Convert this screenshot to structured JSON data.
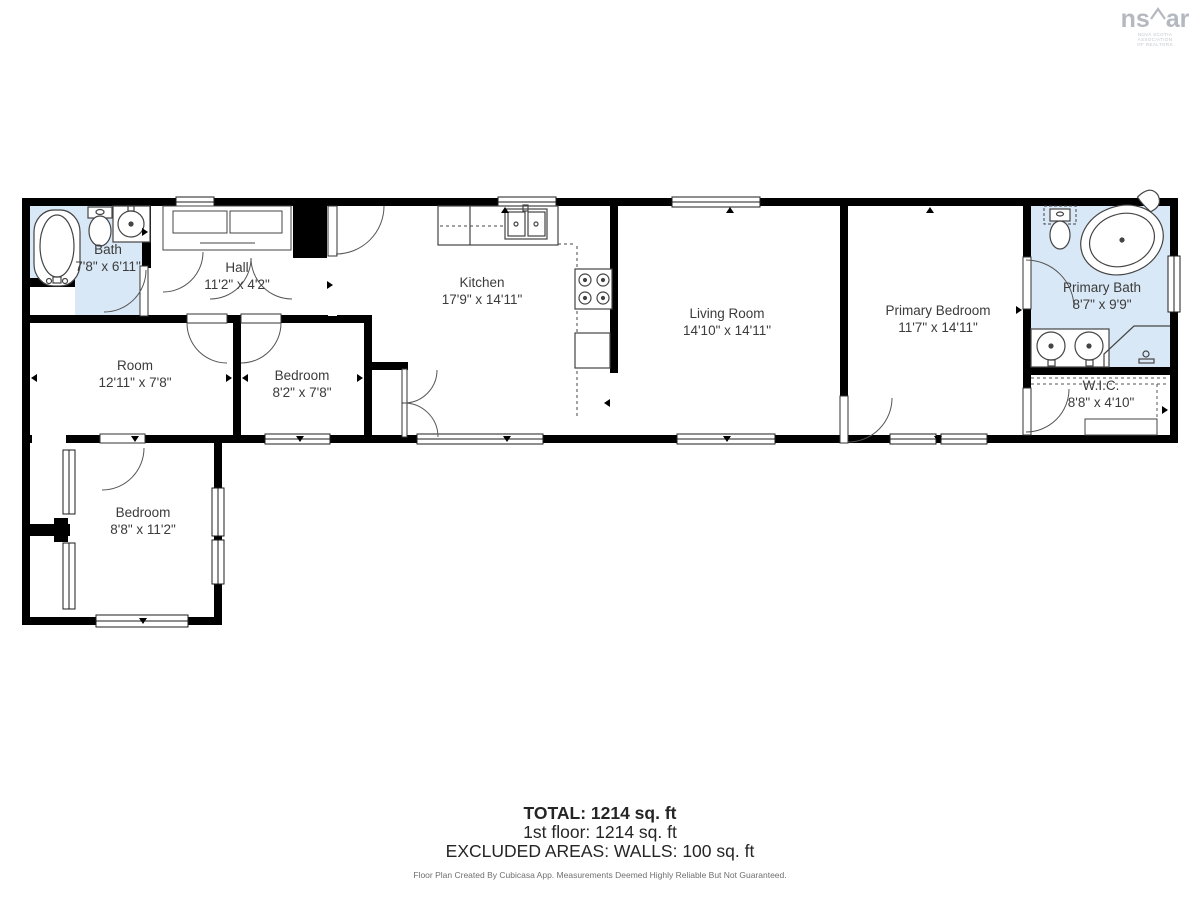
{
  "logo": {
    "mark_left": "ns",
    "mark_right": "ar",
    "roof_glyph": "⌃",
    "sub_line1": "NOVA SCOTIA ASSOCIATION",
    "sub_line2": "OF REALTORS"
  },
  "rooms": [
    {
      "id": "bath",
      "name": "Bath",
      "dims": "7'8\" x 6'11\""
    },
    {
      "id": "hall",
      "name": "Hall",
      "dims": "11'2\" x 4'2\""
    },
    {
      "id": "kitchen",
      "name": "Kitchen",
      "dims": "17'9\" x 14'11\""
    },
    {
      "id": "living-room",
      "name": "Living Room",
      "dims": "14'10\" x 14'11\""
    },
    {
      "id": "primary-bedroom",
      "name": "Primary Bedroom",
      "dims": "11'7\" x 14'11\""
    },
    {
      "id": "primary-bath",
      "name": "Primary Bath",
      "dims": "8'7\" x 9'9\""
    },
    {
      "id": "wic",
      "name": "W.I.C.",
      "dims": "8'8\" x 4'10\""
    },
    {
      "id": "room",
      "name": "Room",
      "dims": "12'11\" x 7'8\""
    },
    {
      "id": "bedroom-small",
      "name": "Bedroom",
      "dims": "8'2\" x 7'8\""
    },
    {
      "id": "bedroom-lower",
      "name": "Bedroom",
      "dims": "8'8\" x 11'2\""
    }
  ],
  "summary": {
    "total": "TOTAL: 1214 sq. ft",
    "floor1": "1st floor: 1214 sq. ft",
    "excluded": "EXCLUDED AREAS: WALLS: 100 sq. ft",
    "disclaimer": "Floor Plan Created By Cubicasa App. Measurements Deemed Highly Reliable But Not Guaranteed."
  },
  "colors": {
    "wet_area": "#d9e8f6",
    "wall": "#000000",
    "label_text": "#3b3b3b"
  }
}
